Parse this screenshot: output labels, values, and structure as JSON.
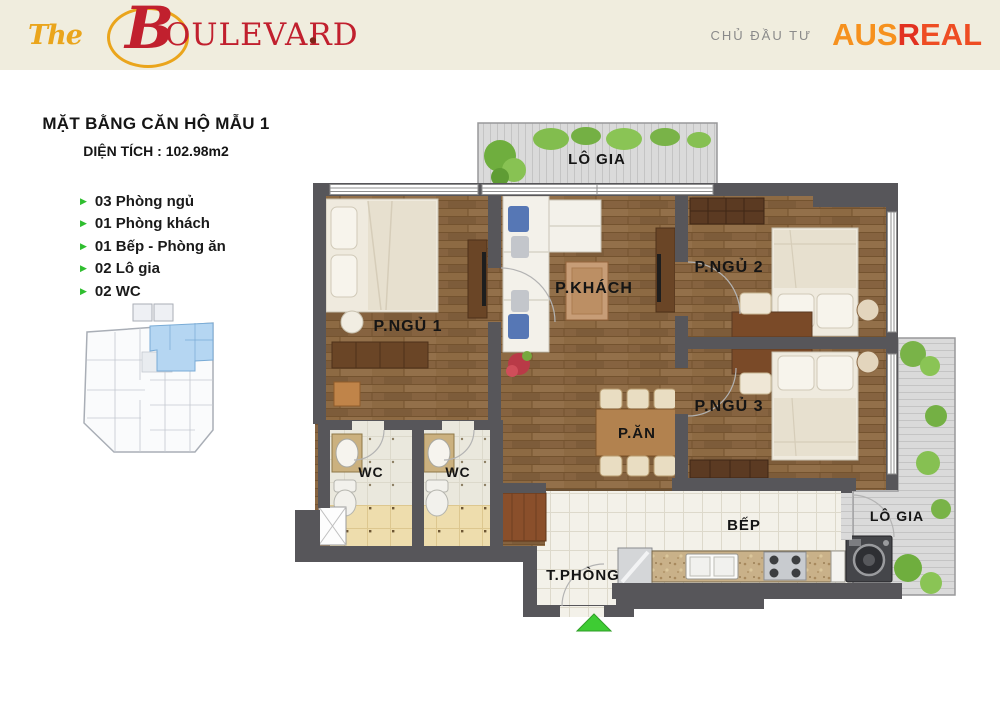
{
  "header": {
    "logo": {
      "the": "The",
      "main_initial": "B",
      "main_rest": "OULEVARD",
      "dot": "."
    },
    "developer_label": "CHỦ ĐẦU TƯ",
    "developer_logo": {
      "part1": "AUS",
      "part2": "R",
      "part3": "EAL"
    }
  },
  "info": {
    "title": "MẶT BẰNG CĂN HỘ MẪU 1",
    "area_line": "DIỆN TÍCH : 102.98m2",
    "features": [
      "03 Phòng ngủ",
      "01 Phòng khách",
      "01 Bếp - Phòng ăn",
      "02 Lô gia",
      "02 WC"
    ]
  },
  "floor_plan": {
    "rooms": {
      "balcony_top": "LÔ GIA",
      "bedroom1": "P.NGỦ 1",
      "living": "P.KHÁCH",
      "bedroom2": "P.NGỦ 2",
      "bedroom3": "P.NGỦ 3",
      "dining": "P.ĂN",
      "wc1": "WC",
      "wc2": "WC",
      "kitchen": "BẾP",
      "utility": "T.PHÒNG",
      "balcony_bottom": "LÔ GIA"
    }
  },
  "colors": {
    "header_bg": "#f0edde",
    "logo_red": "#c1202e",
    "logo_gold": "#eaa51c",
    "ausreal_orange": "#f6911e",
    "ausreal_red": "#e23120",
    "developer_label_gray": "#8a8a8a",
    "bullet_green": "#2fbe2f",
    "wall_gray": "#57565a",
    "wood_floor": "#8d6a43",
    "balcony_floor": "#dadada",
    "entrance_green": "#3ecc33",
    "site_highlight_blue": "#b5d6f2"
  }
}
